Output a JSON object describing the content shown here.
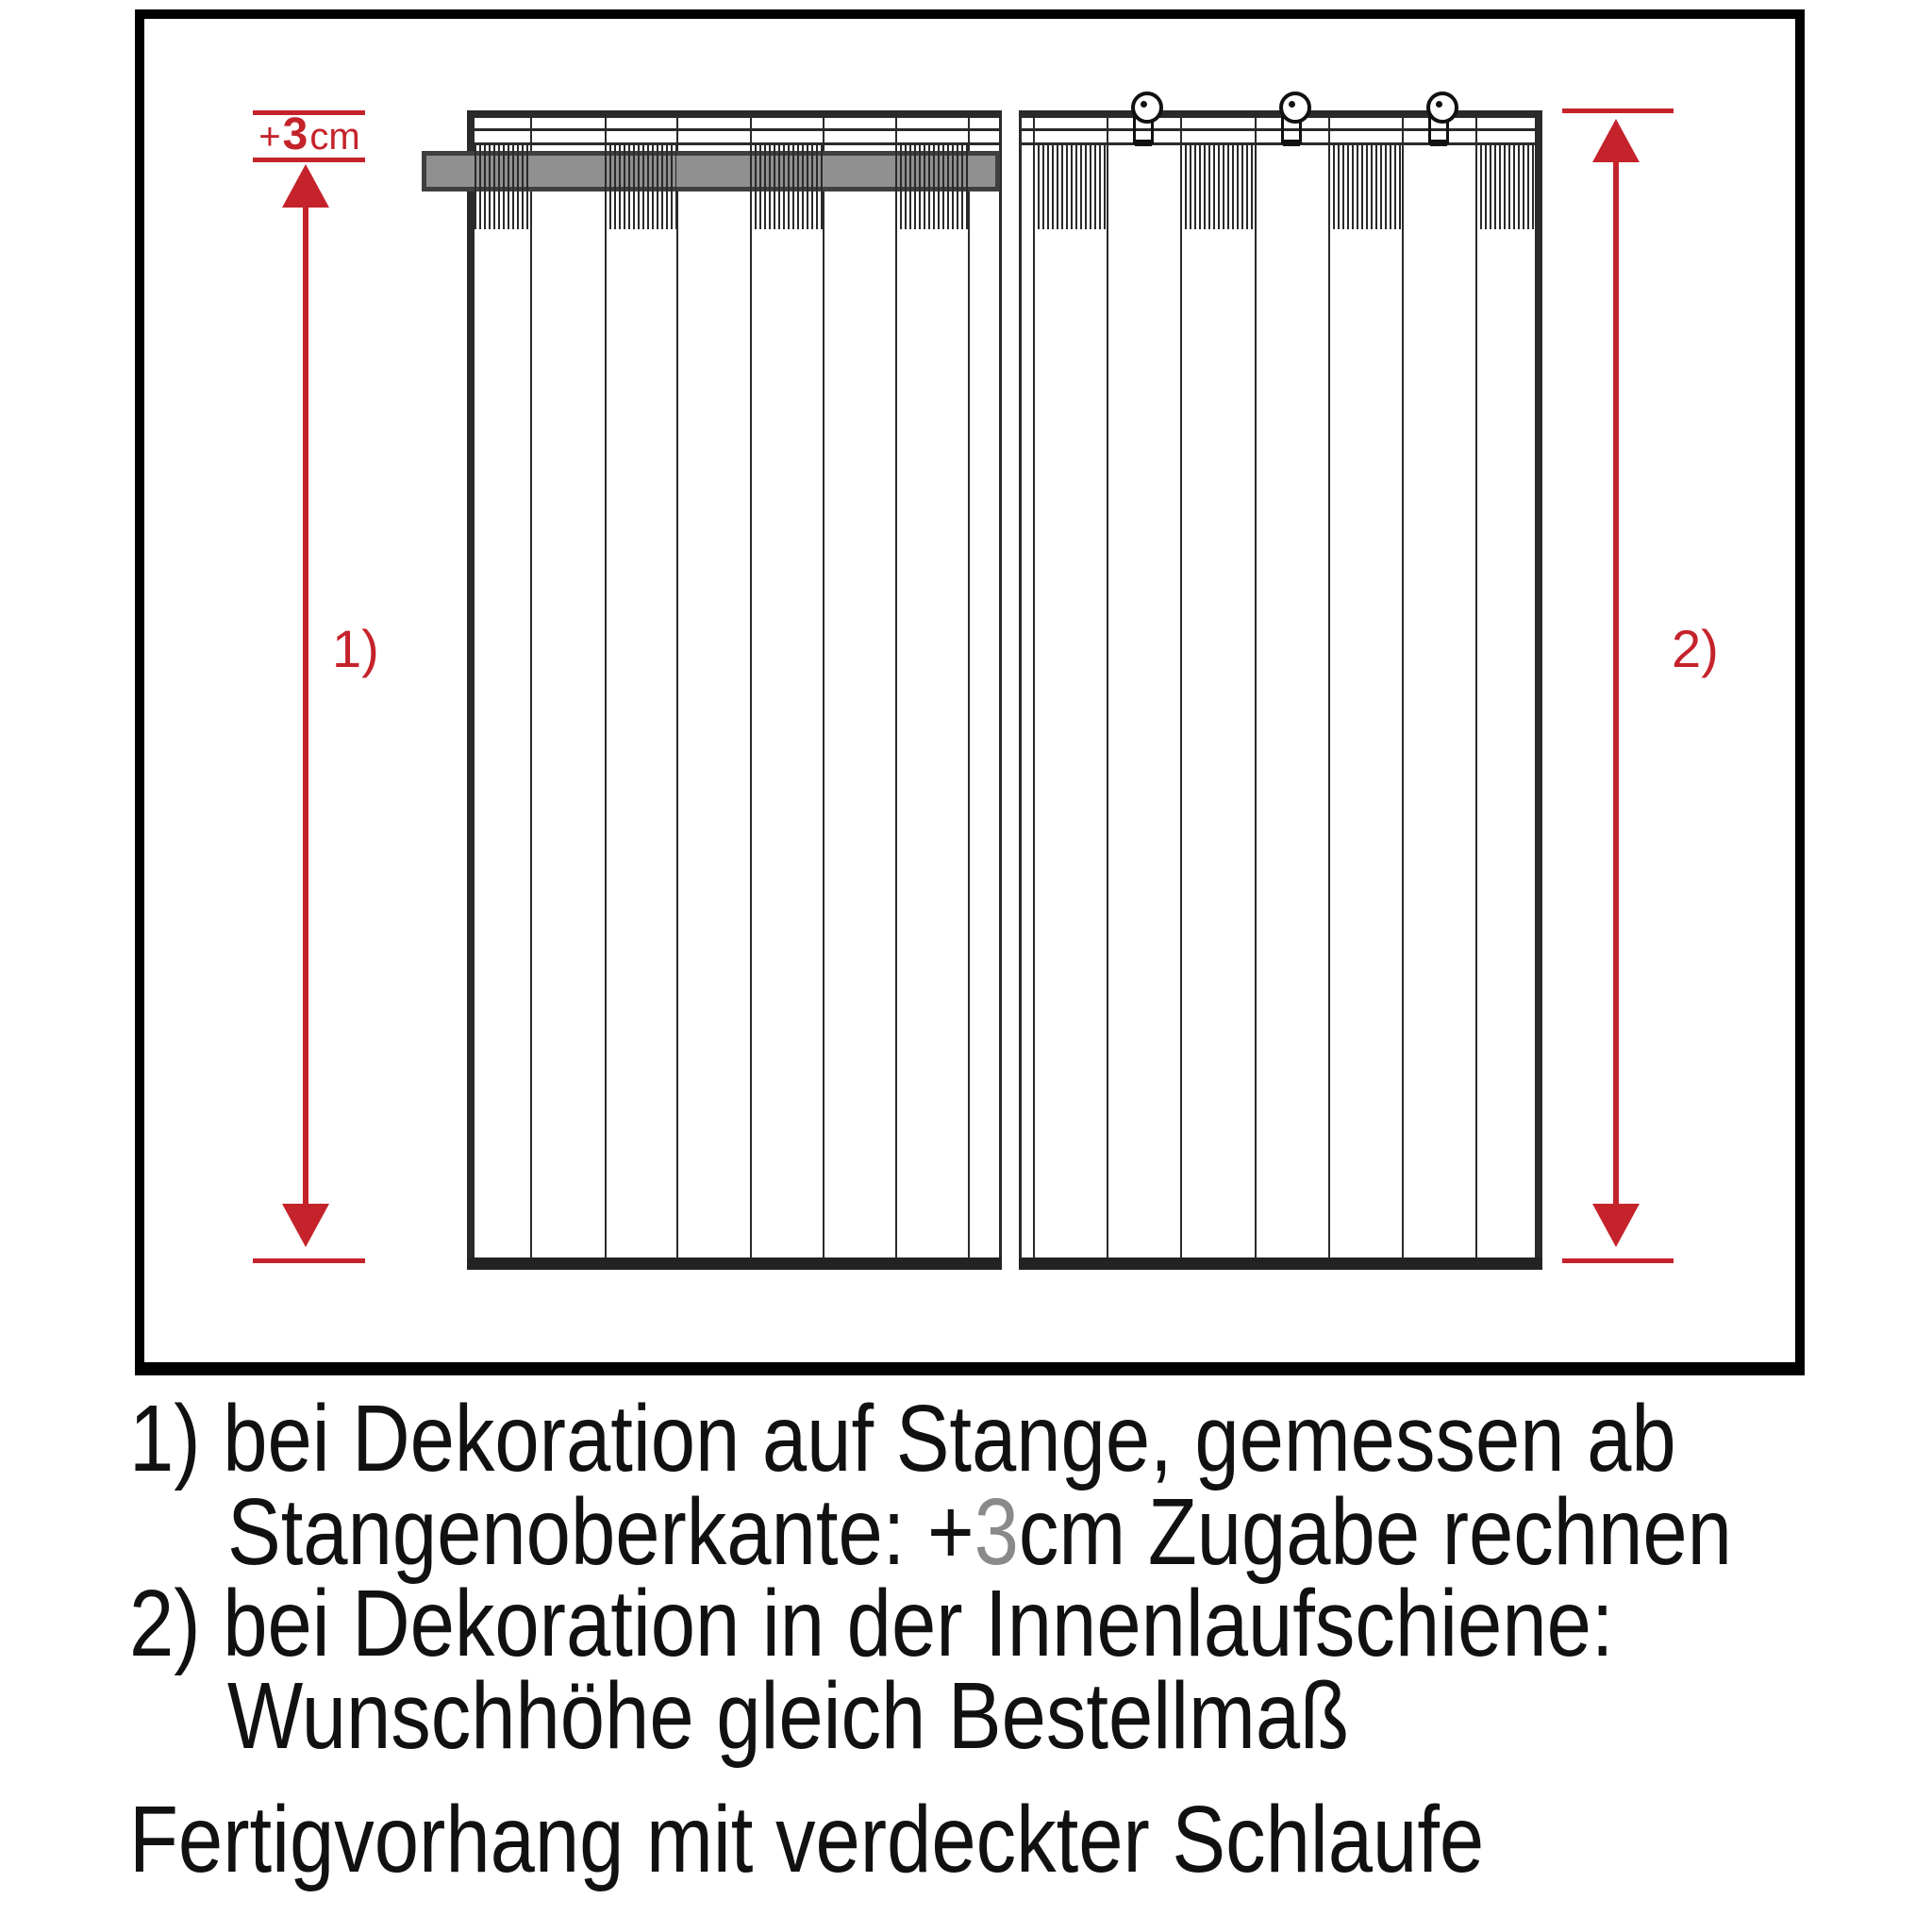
{
  "diagram": {
    "allowance_label": {
      "plus": "+",
      "value": "3",
      "unit": "cm"
    },
    "measure_1_label": "1)",
    "measure_2_label": "2)"
  },
  "caption": {
    "line1": "1) bei Dekoration auf Stange, gemessen ab",
    "line2_prefix": "Stangenoberkante: +",
    "line2_value": "3",
    "line2_suffix": "cm Zugabe rechnen",
    "line3": "2) bei Dekoration in der Innenlaufschiene:",
    "line4": "Wunschhöhe gleich Bestellmaß",
    "line5": "Fertigvorhang mit verdeckter Schlaufe"
  },
  "colors": {
    "annotation_red": "#c5232b",
    "line_ink": "#2a2a2a",
    "text_ink": "#111111",
    "rod_fill": "#909090",
    "rod_outline": "#3f3f3f",
    "caption_value_gray": "#8a8a8a"
  }
}
